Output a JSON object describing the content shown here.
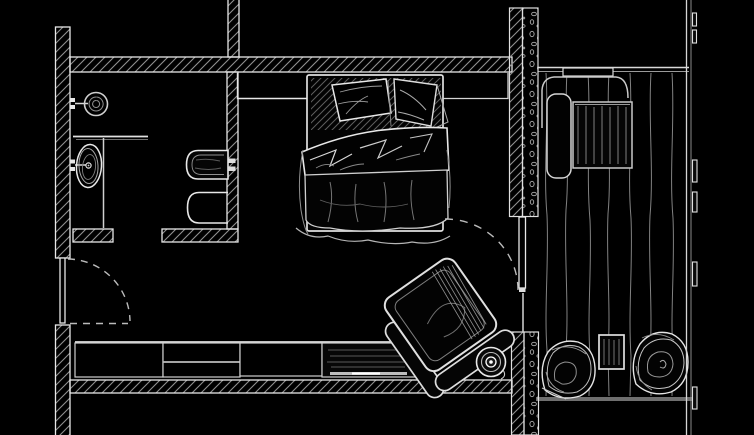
{
  "page": {
    "title": "Hand-drawn floor plan sketch: hotel room with bathroom, double bed, console, armchair and wood-deck terrace",
    "type": "architectural-floor-plan",
    "style": "white line work on black background"
  },
  "canvas": {
    "width": 754,
    "height": 435
  },
  "palette": {
    "background": "#000000",
    "wall_line": "#e8e8e8",
    "line_bright": "#ffffff",
    "line_mid": "#bdbdbd",
    "line_dim": "#8a8a8a",
    "hatch": "#909090",
    "pebble": "#b0b0b0",
    "fill_dark": "#050505"
  },
  "areas": [
    {
      "name": "bathroom",
      "fixtures": [
        "shower-head",
        "washbasin",
        "wall-hung-toilet",
        "bidet",
        "glass-partition"
      ]
    },
    {
      "name": "bedroom",
      "furniture": [
        "double-bed",
        "pillow-left",
        "pillow-right",
        "duvet",
        "side-shelf-left",
        "side-shelf-right",
        "console-sideboard",
        "media-section",
        "armchair",
        "round-stool"
      ]
    },
    {
      "name": "entry-hall",
      "features": [
        "entry-door-leaf",
        "entry-door-swing-arc"
      ]
    },
    {
      "name": "terrace",
      "furniture": [
        "wall-shelf",
        "outdoor-counter",
        "outdoor-bench",
        "outdoor-table",
        "lounge-chair-left",
        "lounge-chair-right",
        "outdoor-side-table"
      ],
      "features": [
        "wood-deck-planks",
        "terrace-door-leaf",
        "terrace-door-swing-arc",
        "stone-infill-wall-column-upper",
        "stone-infill-wall-column-lower",
        "railing-with-posts",
        "terrace-edge"
      ]
    }
  ]
}
